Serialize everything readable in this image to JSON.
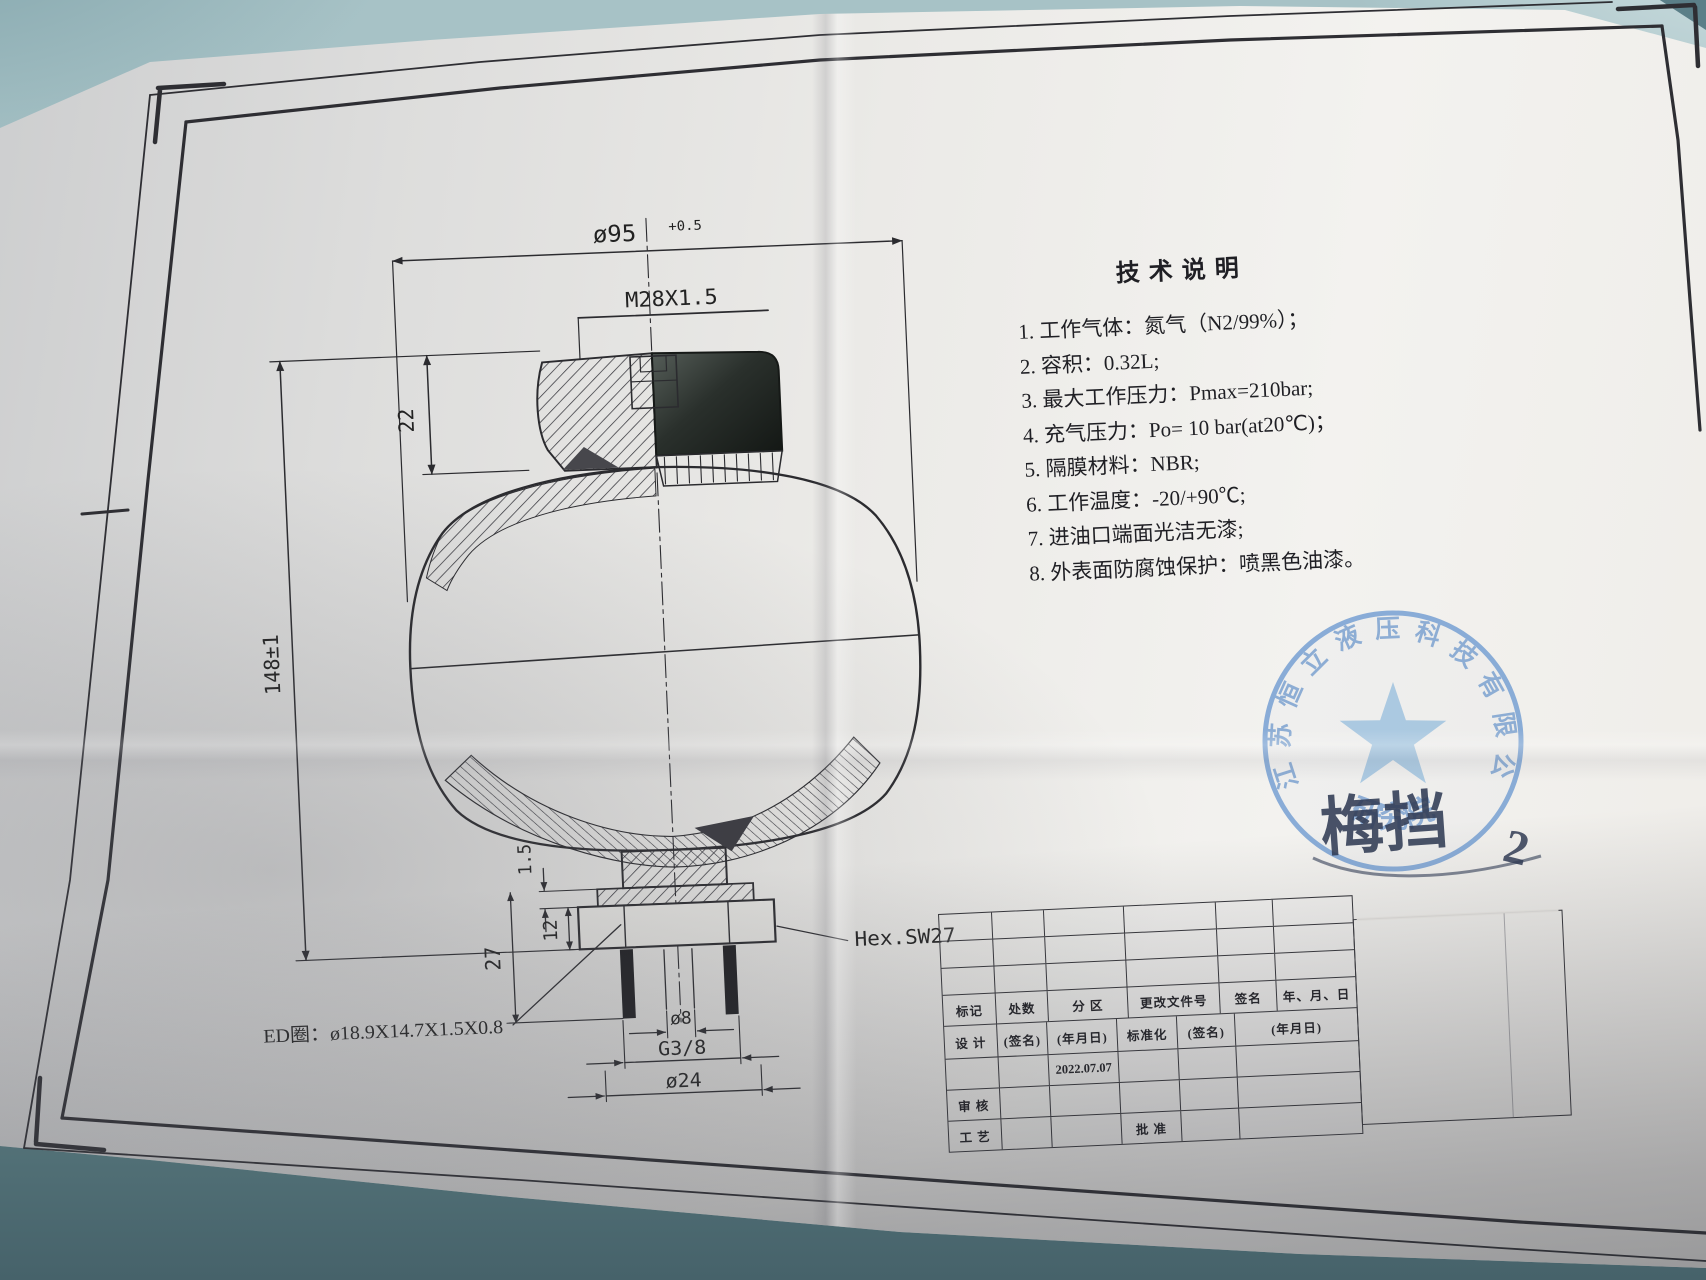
{
  "photo": {
    "table_color": "#a3bfc3",
    "paper_color": "#ebeae7"
  },
  "tech_notes": {
    "title": "技术说明",
    "items": [
      "1. 工作气体：氮气（N2/99%）；",
      "2. 容积：0.32L;",
      "3. 最大工作压力：Pmax=210bar;",
      "4. 充气压力：Po= 10 bar(at20℃)；",
      "5. 隔膜材料：NBR;",
      "6. 工作温度：-20/+90℃;",
      "7. 进油口端面光洁无漆;",
      "8. 外表面防腐蚀保护：喷黑色油漆。"
    ]
  },
  "drawing": {
    "dims": {
      "body_diameter": "ø95",
      "body_diameter_tol": "+0.5",
      "top_thread": "M28X1.5",
      "valve_height": "22",
      "total_height": "148±1",
      "step": "1.5",
      "port_depth": "27",
      "thread_length": "12",
      "bore": "ø8",
      "port_thread": "G3/8",
      "spigot_diameter": "ø24"
    },
    "labels": {
      "hex": "Hex.SW27",
      "seal_ring": "ED圈：ø18.9X14.7X1.5X0.8"
    }
  },
  "title_block": {
    "header": [
      "标记",
      "处数",
      "分 区",
      "更改文件号",
      "签名",
      "年、月、日"
    ],
    "sign": [
      "设 计",
      "(签名)",
      "(年月日)",
      "标准化",
      "(签名)",
      "(年月日)"
    ],
    "design_date": "2022.07.07",
    "audit": "审 核",
    "process": "工 艺",
    "approve": "批 准"
  },
  "stamp": {
    "company": "江苏恒立液压科技有限公司",
    "department": "研究院",
    "handwriting": "梅挡",
    "handwriting_number": "2",
    "color": "#7ba3d4"
  }
}
